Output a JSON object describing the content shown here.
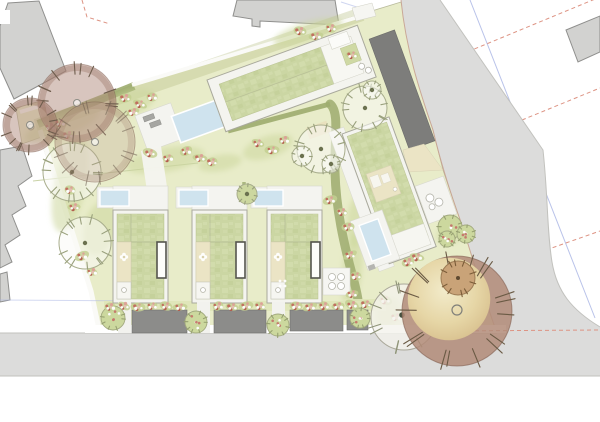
{
  "plan": {
    "kind": "architectural-site-plan",
    "palette": {
      "paper": "#ffffff",
      "parcel": "#e8ecc9",
      "parcel_edge": "#b9bb9c",
      "mound": "#ccd79d",
      "road": "#dcdcdb",
      "road_edge": "#c2c2be",
      "curb_red": "#c59e8c",
      "neighbor": "#d2d2d0",
      "neighbor_edge": "#8f8f8d",
      "roof": "#cbd6a3",
      "roof_light": "#dae3b8",
      "building_white": "#f4f4ef",
      "deck": "#f4f4f0",
      "pool": "#cfe3ee",
      "garage": "#7d7d7b",
      "pad": "#8c8c8a",
      "hedge": "#9dac6e",
      "cream": "#ebe4c5",
      "flower": "#c4766a",
      "tree_mauve": "#b48e7f",
      "tree_tan": "#e2d2a4",
      "dash_red": "#dd9383",
      "line_blue": "#a8b4e4"
    },
    "scene": {
      "houses": {
        "xs": [
          113,
          192,
          267
        ],
        "y": 210,
        "w": 55,
        "h": 93
      },
      "parking_pads": [
        [
          132,
          310,
          55,
          23
        ],
        [
          214,
          310,
          52,
          23
        ],
        [
          290,
          310,
          53,
          21
        ],
        [
          347,
          310,
          21,
          20
        ]
      ],
      "walkways": [
        [
          118,
          302,
          13,
          31
        ],
        [
          197,
          302,
          13,
          31
        ],
        [
          272,
          302,
          13,
          31
        ]
      ],
      "lot_hedges": [
        [
          162,
          186,
          162,
          206
        ],
        [
          244,
          182,
          244,
          204
        ]
      ],
      "mounds": [
        [
          70,
          185,
          16,
          48,
          12
        ],
        [
          62,
          125,
          40,
          12,
          -21
        ],
        [
          130,
          103,
          26,
          12,
          -18
        ],
        [
          165,
          160,
          40,
          12,
          -10
        ],
        [
          220,
          163,
          22,
          8,
          -10
        ],
        [
          268,
          147,
          26,
          11,
          -18
        ],
        [
          308,
          32,
          36,
          10,
          -17
        ],
        [
          352,
          270,
          10,
          38,
          6
        ],
        [
          388,
          312,
          12,
          16,
          20
        ],
        [
          356,
          222,
          9,
          26,
          4
        ],
        [
          452,
          233,
          16,
          10,
          -20
        ],
        [
          100,
          228,
          16,
          28,
          14
        ]
      ],
      "existing_trees": [
        {
          "x": 77,
          "y": 103,
          "r": 39,
          "kind": "mauve"
        },
        {
          "x": 30,
          "y": 125,
          "r": 27,
          "kind": "mauve"
        },
        {
          "x": 95,
          "y": 142,
          "r": 40,
          "kind": "mauve-faint"
        },
        {
          "x": 404,
          "y": 317,
          "r": 33,
          "kind": "pale"
        },
        {
          "x": 457,
          "y": 311,
          "r": 55,
          "kind": "tan-big"
        },
        {
          "x": 458,
          "y": 278,
          "r": 17,
          "kind": "tan-small"
        }
      ],
      "proposed_trees": [
        {
          "x": 72,
          "y": 172,
          "r": 29
        },
        {
          "x": 85,
          "y": 243,
          "r": 26
        },
        {
          "x": 321,
          "y": 149,
          "r": 24
        },
        {
          "x": 302,
          "y": 156,
          "r": 10
        },
        {
          "x": 331,
          "y": 164,
          "r": 9
        },
        {
          "x": 365,
          "y": 108,
          "r": 22
        },
        {
          "x": 372,
          "y": 90,
          "r": 9
        },
        {
          "x": 247,
          "y": 194,
          "r": 10,
          "green": true
        }
      ],
      "flowering_trees": [
        [
          113,
          318,
          12
        ],
        [
          196,
          322,
          11
        ],
        [
          278,
          325,
          11
        ],
        [
          360,
          318,
          10
        ],
        [
          450,
          227,
          12
        ],
        [
          466,
          234,
          9
        ],
        [
          447,
          239,
          8
        ]
      ],
      "flower_clusters": [
        [
          50,
          127
        ],
        [
          60,
          123
        ],
        [
          68,
          135
        ],
        [
          70,
          190
        ],
        [
          74,
          207
        ],
        [
          82,
          256
        ],
        [
          92,
          272
        ],
        [
          125,
          98
        ],
        [
          140,
          104
        ],
        [
          152,
          97
        ],
        [
          133,
          112
        ],
        [
          150,
          153
        ],
        [
          168,
          158
        ],
        [
          186,
          151
        ],
        [
          200,
          158
        ],
        [
          212,
          162
        ],
        [
          258,
          143
        ],
        [
          272,
          150
        ],
        [
          284,
          140
        ],
        [
          300,
          31
        ],
        [
          316,
          36
        ],
        [
          331,
          28
        ],
        [
          352,
          55
        ],
        [
          330,
          200
        ],
        [
          342,
          212
        ],
        [
          348,
          227
        ],
        [
          350,
          255
        ],
        [
          356,
          276
        ],
        [
          352,
          294
        ],
        [
          385,
          300
        ],
        [
          396,
          317
        ],
        [
          408,
          262
        ],
        [
          417,
          257
        ],
        [
          110,
          307
        ],
        [
          124,
          306
        ],
        [
          138,
          307
        ],
        [
          152,
          306
        ],
        [
          166,
          306
        ],
        [
          180,
          307
        ],
        [
          218,
          306
        ],
        [
          232,
          307
        ],
        [
          246,
          306
        ],
        [
          260,
          306
        ],
        [
          296,
          306
        ],
        [
          310,
          307
        ],
        [
          324,
          306
        ],
        [
          338,
          306
        ],
        [
          352,
          305
        ],
        [
          366,
          304
        ]
      ]
    }
  }
}
